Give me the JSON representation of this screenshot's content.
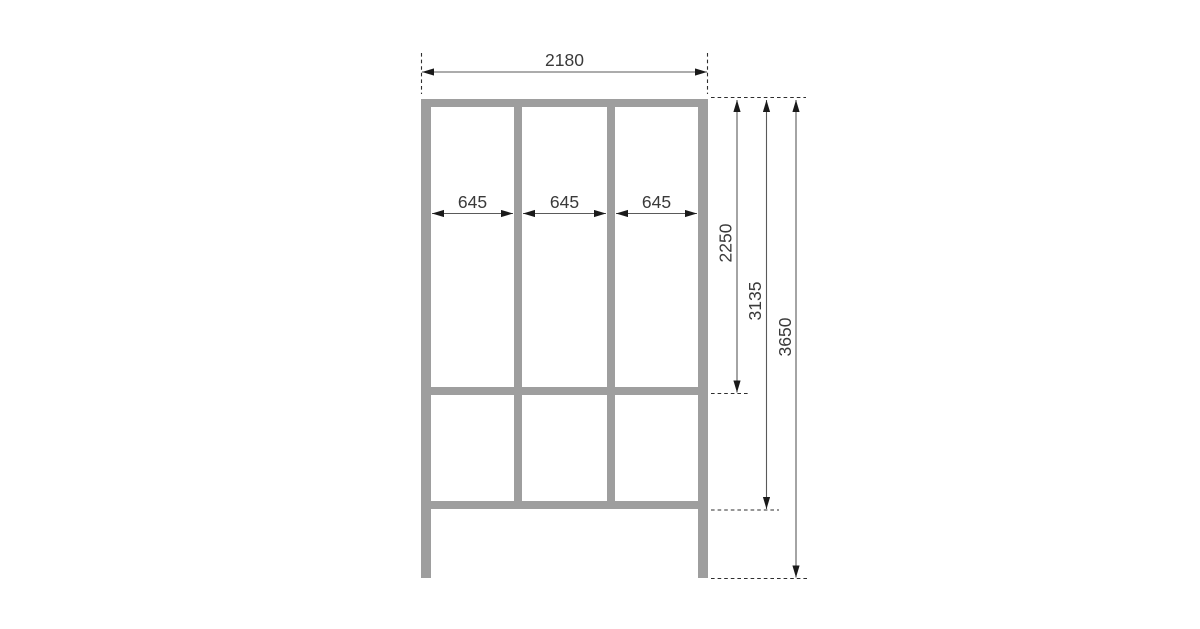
{
  "drawing": {
    "name": "Frame elevation with dimensions",
    "colors": {
      "background": "#ffffff",
      "frame": "#9e9e9e",
      "dimension_line": "#5a5a5a",
      "extension_line": "#2e2e2e",
      "arrow": "#1a1a1a",
      "label": "#3a3a3a"
    },
    "dimensions": {
      "overall_width": "2180",
      "bay_widths": [
        "645",
        "645",
        "645"
      ],
      "upper_section_height": "2250",
      "frame_height": "3135",
      "overall_height": "3650"
    }
  }
}
